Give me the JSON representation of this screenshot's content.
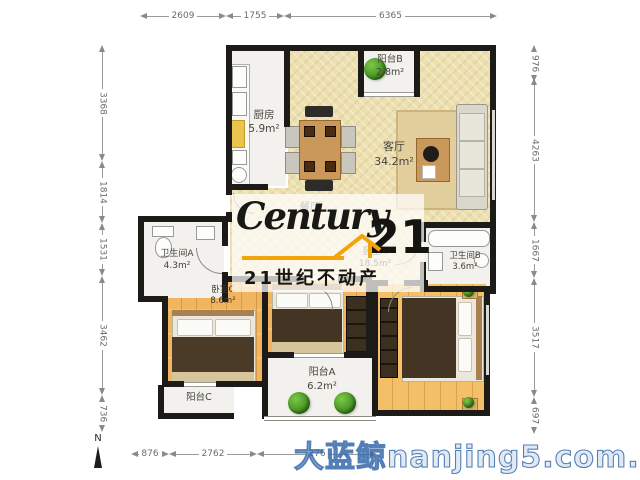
{
  "dimensions": {
    "top": [
      "2609",
      "1755",
      "6365"
    ],
    "left": [
      "3368",
      "1814",
      "1531",
      "3462",
      "736"
    ],
    "right": [
      "976",
      "4263",
      "1667",
      "3517",
      "697"
    ],
    "bottom": [
      "876",
      "2762",
      "276"
    ]
  },
  "rooms": {
    "balcony_b": {
      "name": "阳台B",
      "area": "2.8m²"
    },
    "kitchen": {
      "name": "厨房",
      "area": "5.9m²"
    },
    "dining": {
      "name": "餐厅",
      "area": ""
    },
    "living": {
      "name": "客厅",
      "area": "34.2m²"
    },
    "bath_a": {
      "name": "卫生间A",
      "area": "4.3m²"
    },
    "bath_b": {
      "name": "卫生间B",
      "area": "3.6m²"
    },
    "bed_c": {
      "name": "卧室C",
      "area": "8.6m²"
    },
    "bed_a": {
      "name": "卧室A",
      "area": "18.5m²"
    },
    "balcony_a": {
      "name": "阳台A",
      "area": "6.2m²"
    },
    "balcony_c": {
      "name": "阳台C",
      "area": ""
    }
  },
  "logo": {
    "brand_script": "Century",
    "brand_number": "21",
    "brand_cn": "21世纪不动产",
    "gold_color": "#f2a50a"
  },
  "watermark_bottom": "大蓝鲸nanjing5.com.cn",
  "compass": {
    "label": "N"
  },
  "colors": {
    "wall": "#1c1b18",
    "floor_beige": "#ecdfb0",
    "floor_wood": "#f0b55e",
    "floor_white": "#f2f1ed",
    "watermark_blue": "#3a6caa",
    "dimension_text": "#6b6b6b"
  }
}
